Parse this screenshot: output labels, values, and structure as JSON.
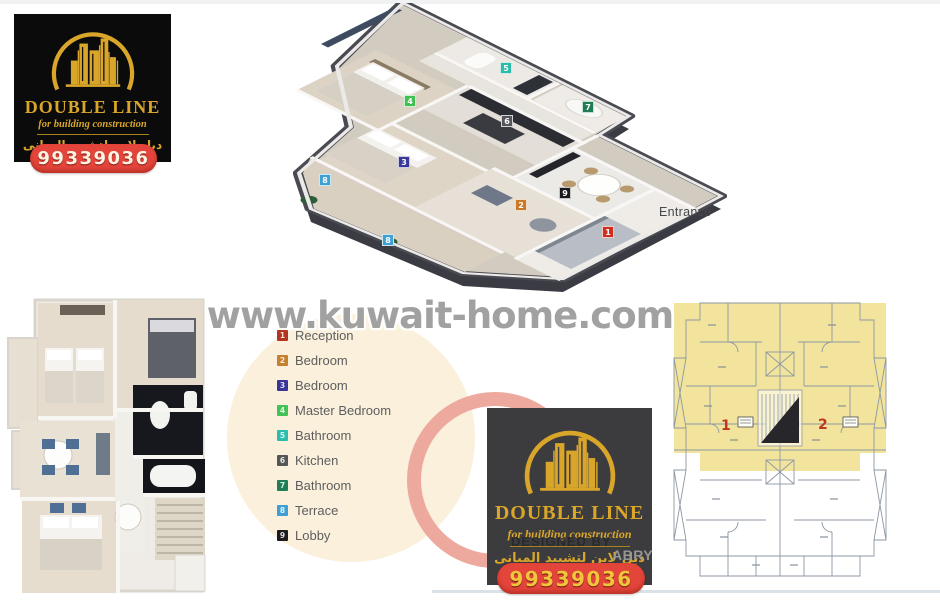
{
  "brand_top": {
    "name": "DOUBLE LINE",
    "tagline": "for building construction",
    "tagline_ar": "دبل لاين لتشييد المبانى",
    "phone": "99339036"
  },
  "brand_bottom": {
    "name": "DOUBLE LINE",
    "tagline": "for building construction",
    "tagline_ar": "دبل لاين لتشييد المبانى",
    "phone": "99339036"
  },
  "watermark": {
    "site": "www.kuwait-home.com"
  },
  "designer_credit": {
    "line1": "DESIGNED BY",
    "name": "ABRY",
    "tel": "TEL: 50455672"
  },
  "plan_3d": {
    "entrance_label": "Entrance",
    "markers": [
      {
        "num": "1",
        "room": "Reception",
        "color": "#cf2f20"
      },
      {
        "num": "2",
        "room": "Bedroom",
        "color": "#c8792a"
      },
      {
        "num": "3",
        "room": "Bedroom",
        "color": "#3a3898"
      },
      {
        "num": "4",
        "room": "Master Bedroom",
        "color": "#40bf52"
      },
      {
        "num": "5",
        "room": "Bathroom",
        "color": "#2cbaa9"
      },
      {
        "num": "6",
        "room": "Kitchen",
        "color": "#55555c"
      },
      {
        "num": "7",
        "room": "Bathroom",
        "color": "#1f7d55"
      },
      {
        "num": "8",
        "room": "Terrace",
        "color": "#3fa0d3"
      },
      {
        "num": "9",
        "room": "Lobby",
        "color": "#1a1a1e"
      },
      {
        "num": "8",
        "room": "Terrace",
        "color": "#3fa0d3"
      }
    ]
  },
  "legend": {
    "items": [
      {
        "num": "1",
        "label": "Reception",
        "color": "#b43420"
      },
      {
        "num": "2",
        "label": "Bedroom",
        "color": "#c5812d"
      },
      {
        "num": "3",
        "label": "Bedroom",
        "color": "#37359a"
      },
      {
        "num": "4",
        "label": "Master Bedroom",
        "color": "#43c355"
      },
      {
        "num": "5",
        "label": "Bathroom",
        "color": "#2bbcab"
      },
      {
        "num": "6",
        "label": "Kitchen",
        "color": "#565656"
      },
      {
        "num": "7",
        "label": "Bathroom",
        "color": "#1f7e57"
      },
      {
        "num": "8",
        "label": "Terrace",
        "color": "#3f9fd3"
      },
      {
        "num": "9",
        "label": "Lobby",
        "color": "#1b1b1e"
      }
    ]
  },
  "plan_2d": {
    "units": [
      {
        "label": "1",
        "color": "#bf3526"
      },
      {
        "label": "2",
        "color": "#bf3526"
      }
    ]
  }
}
